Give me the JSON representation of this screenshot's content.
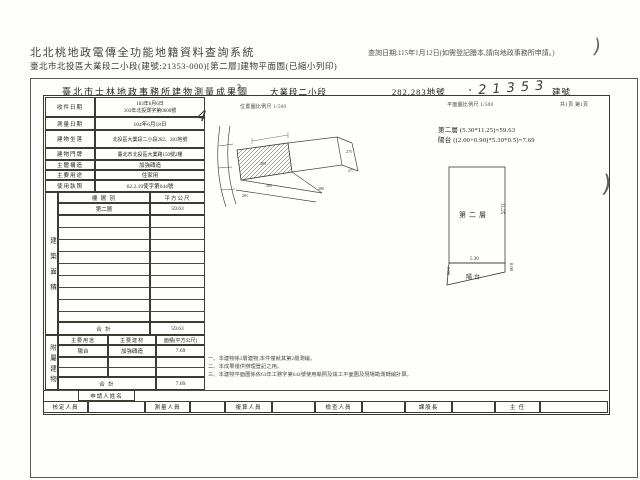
{
  "colors": {
    "line": "#38382f",
    "chrome_text": "#47443e",
    "watermark": "#e9e8e4"
  },
  "chrome": {
    "system_title": "北北桃地政電傳全功能地籍資料查詢系統",
    "query_date": "查詢日期:115年1月12日(如需登記謄本,請向地政事務所申請。)",
    "doc_subtitle": "臺北市北投區大業段二小段(建號:21353-000)[第二層]建物平面圖(已縮小列印)"
  },
  "header": {
    "office_title": "臺北市士林地政事務所建物測量成果圖",
    "title_mark": "?",
    "section": "大業段二小段",
    "parcel_no": "282,283地號",
    "building_no_hand": "‧21353",
    "building_no_suffix": "建號",
    "scale_left": "位置圖比例尺 1/500",
    "scale_right": "平面圖比例尺 1/500",
    "page_info": "共1頁 第1頁",
    "hand_mark": "4"
  },
  "info_table": {
    "rows": [
      {
        "label": "收件日期",
        "value": "103年6月6日",
        "value2": "103年北投測字第0600號"
      },
      {
        "label": "測量日期",
        "value": "104年6月18日"
      },
      {
        "label": "建物坐落",
        "value": "北投區大業段二小段282、283地號"
      },
      {
        "label": "建物門牌",
        "value": "臺北市北投區大業路150號2樓"
      },
      {
        "label": "主體構造",
        "value": "加強磚造"
      },
      {
        "label": "主要用途",
        "value": "住家用"
      },
      {
        "label": "使用執照",
        "value": "62.2.19使字第044號"
      }
    ]
  },
  "area_table": {
    "side_label": "建築面積",
    "col_floor": "樓 層 別",
    "col_area": "平方公尺",
    "floor": "第二層",
    "floor_area": "59.63",
    "total_label": "合  計",
    "total": "59.63"
  },
  "annex_table": {
    "side_label": "附屬建物",
    "col_use": "主要用途",
    "col_material": "主要建材",
    "col_area": "面積(平方公尺)",
    "row_use": "陽台",
    "row_material": "加強磚造",
    "row_area": "7.69",
    "total_label": "合  計",
    "total": "7.69"
  },
  "calc": {
    "line1": "第二層 (5.30*11.25)=59.63",
    "line2": "陽台 ((2.00+0.90)*5.30*0.5)=7.69"
  },
  "notes": [
    "一、本建物係3層建物,本件僅就其第2層測繪。",
    "二、本成果僅供辦理登記之用。",
    "三、本建物平面圖係依63年工務字第644號使用執照及竣工平面圖及現場勘測轉繪計算。"
  ],
  "plan": {
    "floor_label": "第二層",
    "dim_height": "11.25",
    "dim_width": "5.30",
    "balcony_label": "陽台",
    "balcony_left": "2.00",
    "balcony_right": "0.90"
  },
  "sketch": {
    "lots": [
      "283",
      "282",
      "281",
      "275",
      "277",
      "280"
    ]
  },
  "footer": {
    "applicant_label": "申請人姓名",
    "signers": [
      "核定人員",
      "測量人員",
      "複算人員",
      "檢查人員",
      "課股長",
      "主 任"
    ]
  },
  "watermark": {
    "line1": "TORO",
    "line2": "ESTATE",
    "line3": "不動產"
  }
}
